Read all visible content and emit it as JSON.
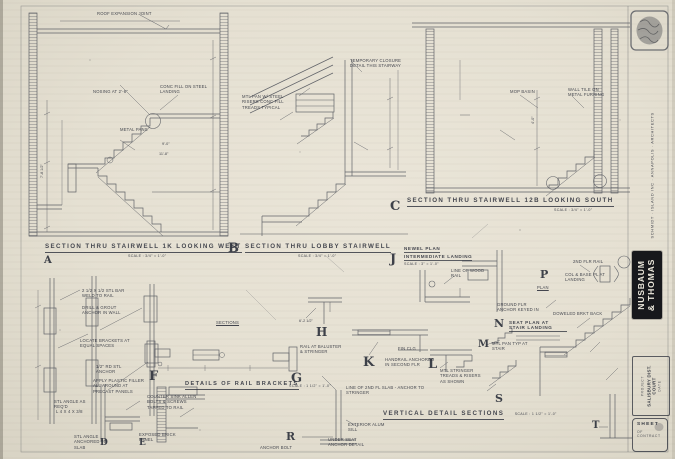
{
  "colors": {
    "paper": "#e5e0d2",
    "ink": "#2f333c",
    "firm_box": "#17181c"
  },
  "sections": {
    "a": {
      "title": "SECTION THRU STAIRWELL 1K LOOKING WEST",
      "scale": "SCALE : 3/4\" = 1'-0\""
    },
    "b": {
      "title": "SECTION THRU LOBBY STAIRWELL",
      "scale": "SCALE : 3/4\" = 1'-0\""
    },
    "c": {
      "title": "SECTION THRU STAIRWELL 12B LOOKING SOUTH",
      "scale": "SCALE : 3/4\" = 1'-0\""
    },
    "rail_brackets": {
      "title": "DETAILS OF RAIL BRACKETS",
      "scale": "SCALE : 1 1/2\" = 1'-0\""
    },
    "newel_plan": {
      "title_line1": "NEWEL PLAN",
      "title_line2": "INTERMEDIATE LANDING",
      "scale": "SCALE : 3\" = 1'-0\""
    },
    "vertical_details": {
      "title": "VERTICAL DETAIL SECTIONS",
      "scale": "SCALE : 1 1/2\" = 1'-0\""
    },
    "seat_plan": {
      "title": "SEAT PLAN AT STAIR LANDING"
    }
  },
  "letters": {
    "a": "A",
    "b": "B",
    "c": "C",
    "d": "D",
    "e": "E",
    "f": "F",
    "g": "G",
    "h": "H",
    "j": "J",
    "k": "K",
    "l": "L",
    "m": "M",
    "n": "N",
    "p": "P",
    "r": "R",
    "s": "S",
    "t": "T"
  },
  "notes": {
    "roof_joint": "ROOF EXPANSION JOINT",
    "conc_fill": "CONC FILL ON STEEL LANDING",
    "nosing": "NOSING AT 2'-6\"",
    "metal_pans": "METAL PANS",
    "temp_closure": "TEMPORARY CLOSURE DETAIL THIS STAIRWAY",
    "mtl_pan_b": "MTL PAN W/ STEEL RISERS CONC FILL TREADS TYPICAL",
    "mop_basin": "MOP BASIN",
    "wall_tile": "WALL TILE ON METAL FURRING",
    "handrail_anchor": "HANDRAIL ANCHORED IN SECOND FLR",
    "rail_baluster": "RAIL AT BALUSTER & STRINGER",
    "line_2nd_fl": "LINE OF 2ND FL SLAB - ANCHOR TO STRINGER",
    "fin_clg": "FIN CLG",
    "mtl_stringer": "MTL STRINGER TREADS & RISERS AS SHOWN",
    "col_base": "COL & BASE PL AT LANDING",
    "second_flr_rail": "2ND FLR RAIL",
    "doweled": "DOWELED BRKT BACK",
    "ground_anchor": "GROUND FLR ANCHOR KEYED IN",
    "plan_label": "PLAN",
    "wood_rail": "LINE OF WOOD RAIL",
    "counter_sink": "COUNTER SINK ALLEN BOLTS & SCREWS TAPPED TO RAIL",
    "stl_bar": "2 1/2 x 1/2 STL BAR WELD TO RAIL",
    "drill_grout": "DRILL & GROUT ANCHOR IN WALL",
    "locate_brackets": "LOCATE BRACKETS AT EQUAL SPACES",
    "rd_anchor": "1/2\" RD STL ANCHOR",
    "plastic_filler": "APPLY PLASTIC FILLER ALL AROUND AT PRECAST PANELS",
    "stl_angle": "STL ANGLE AS REQ'D",
    "angle_size": "L 4 x 4 x 3/8",
    "angle_anchored": "STL ANGLE ANCHORED TO SLAB",
    "exposed_brick": "EXPOSED BRICK PANEL",
    "alum_sill": "EXTERIOR ALUM SILL",
    "under_seat": "UNDER SEAT ANCHOR DETAIL",
    "anchor_bolt": "ANCHOR BOLT",
    "sections_label": "SECTIONS",
    "mtl_pan_stair": "MTL PAN TYP AT STAIR"
  },
  "dims": {
    "a_run": "9'-0\"",
    "a_run2": "11'-8\"",
    "a_height": "7'-8 1/2\"",
    "c_height": "4'-0\"",
    "h_width": "6'-2 1/2\""
  },
  "titleblock": {
    "architects": "SCHMIDT · ISLAND INC · ANNAPOLIS · ARCHITECTS",
    "firm_line1": "NUSBAUM",
    "firm_line2": "& THOMAS",
    "project_label": "PROJECT",
    "project_name": "SALISBURY DIST. COURT",
    "date_label": "DATE",
    "sheet_label": "SHEET",
    "sheet_of": "OF CONTRACT"
  }
}
